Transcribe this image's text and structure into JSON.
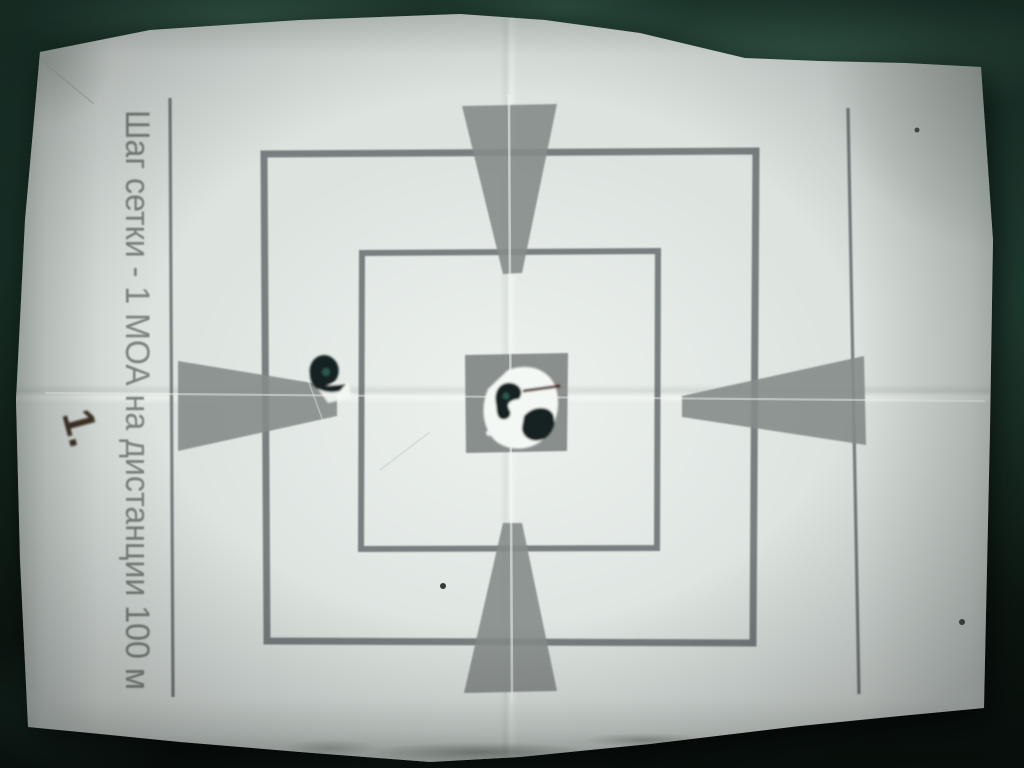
{
  "photo": {
    "labels": {
      "grid_step": "Шаг сетки - 1 МОА на дистанции 100 м",
      "handwritten_number": "1."
    },
    "colors": {
      "fabric_green": "#1b352b",
      "paper_white": "#e3eae6",
      "print_gray": "#858c8a",
      "print_line_gray": "#62696a",
      "label_gray": "#7d847f",
      "hole_black": "#142320",
      "torn_paper_white": "#f4f8f4",
      "mark_brown": "#30221a"
    }
  }
}
